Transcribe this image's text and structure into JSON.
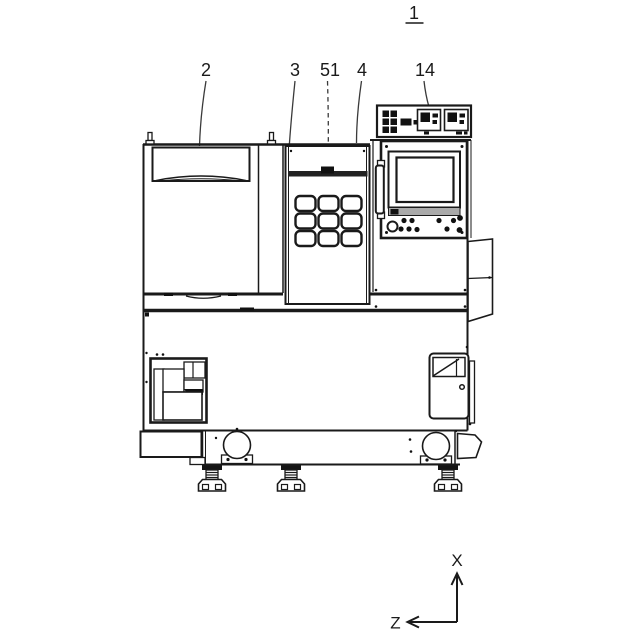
{
  "figure": {
    "labels": {
      "ref1": "1",
      "ref2": "2",
      "ref3": "3",
      "ref51": "51",
      "ref4": "4",
      "ref14": "14"
    },
    "axis_indicator": {
      "up": "X",
      "left": "Z"
    },
    "colors": {
      "line": "#1a1a1a",
      "background": "#ffffff"
    }
  }
}
